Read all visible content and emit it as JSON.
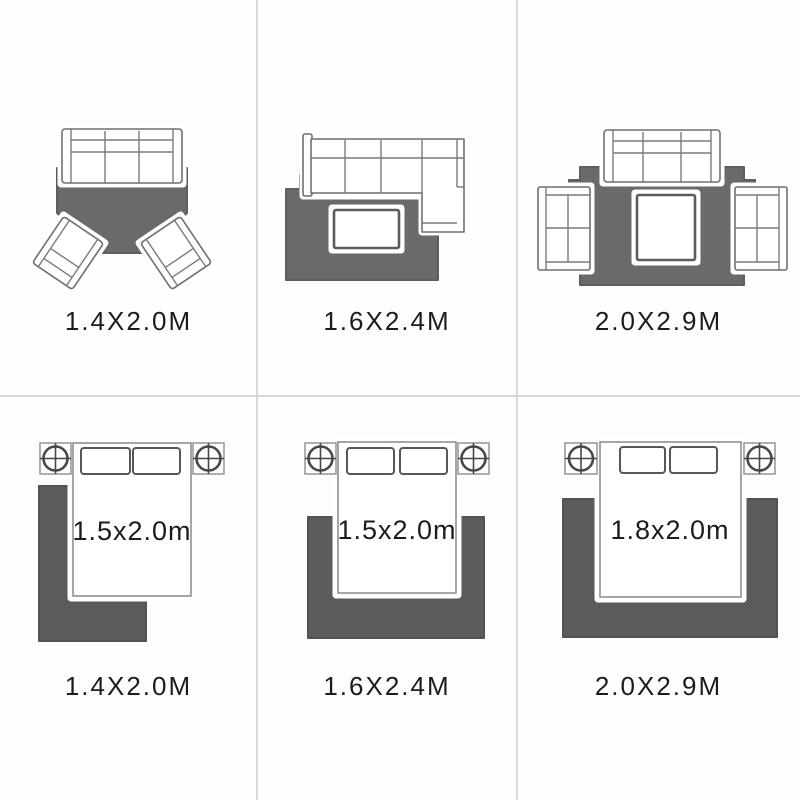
{
  "panels": [
    {
      "name": "living-room-sofa-two-armchairs",
      "caption": "1.4X2.0M"
    },
    {
      "name": "living-room-sectional-sofa",
      "caption": "1.6X2.4M"
    },
    {
      "name": "living-room-sofa-two-loveseats",
      "caption": "2.0X2.9M"
    },
    {
      "name": "bedroom-offset-rug",
      "bed_size": "1.5x2.0m",
      "caption": "1.4X2.0M"
    },
    {
      "name": "bedroom-centered-rug",
      "bed_size": "1.5x2.0m",
      "caption": "1.6X2.4M"
    },
    {
      "name": "bedroom-wide-rug",
      "bed_size": "1.8x2.0m",
      "caption": "2.0X2.9M"
    }
  ],
  "colors": {
    "rug_top": "#6a6a6a",
    "rug_bottom": "#5b5b5b",
    "divider": "#d8d8d8",
    "label": "#1c1c1c"
  }
}
